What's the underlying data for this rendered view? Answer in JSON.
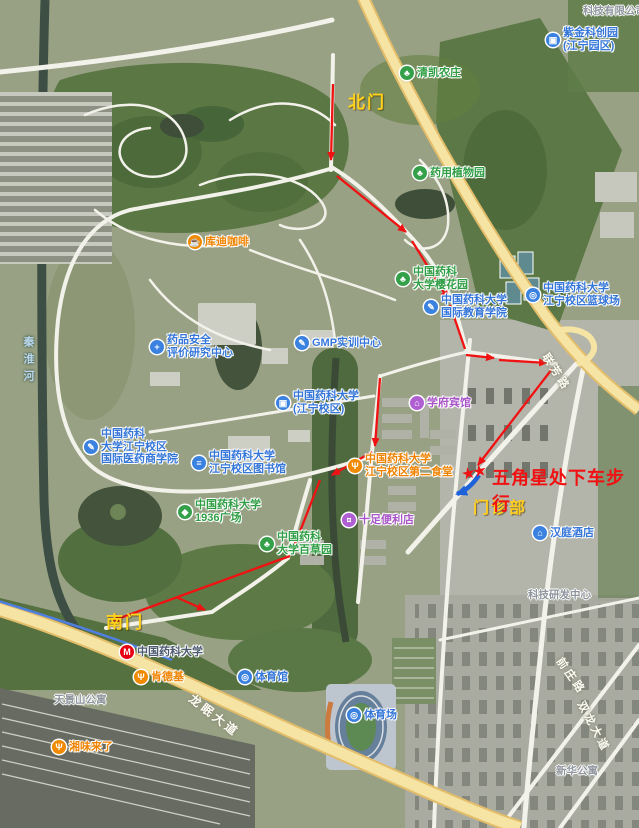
{
  "annotations": {
    "north_gate": "北门",
    "south_gate": "南门",
    "clinic": "门诊部",
    "instruction": "五角星处下车步行",
    "stars": "★★"
  },
  "colors": {
    "route_red": "#f01212",
    "walk_arrow_blue": "#1e62d9",
    "gate_yellow": "#ffd21c",
    "poi_green": "#2f9e44",
    "poi_blue": "#3576d9",
    "poi_orange": "#f08a00",
    "poi_purple": "#b05fd3",
    "metro_red": "#e60012",
    "main_road_yellow": "#f5e4a4"
  },
  "pois": [
    {
      "lines": [
        "清凯农庄"
      ],
      "glyph": "♣",
      "type": "farm"
    },
    {
      "lines": [
        "药用植物园"
      ],
      "glyph": "♣",
      "type": "garden"
    },
    {
      "lines": [
        "库迪咖啡"
      ],
      "glyph": "☕",
      "type": "coffee"
    },
    {
      "lines": [
        "中国药科",
        "大学樱花园"
      ],
      "glyph": "♣",
      "type": "garden"
    },
    {
      "lines": [
        "中国药科大学",
        "国际教育学院"
      ],
      "glyph": "✎",
      "type": "education"
    },
    {
      "lines": [
        "中国药科大学",
        "江宁校区篮球场"
      ],
      "glyph": "◎",
      "type": "sports"
    },
    {
      "lines": [
        "GMP实训中心"
      ],
      "glyph": "✎",
      "type": "education"
    },
    {
      "lines": [
        "药品安全",
        "评价研究中心"
      ],
      "glyph": "+",
      "type": "research"
    },
    {
      "lines": [
        "中国药科大学",
        "(江宁校区)"
      ],
      "glyph": "▣",
      "type": "bus-stop"
    },
    {
      "lines": [
        "学府宾馆"
      ],
      "glyph": "⌂",
      "type": "hotel"
    },
    {
      "lines": [
        "中国药科大学",
        "江宁校区第二食堂"
      ],
      "glyph": "Ψ",
      "type": "canteen"
    },
    {
      "lines": [
        "中国药科",
        "大学江宁校区",
        "国际医药商学院"
      ],
      "glyph": "✎",
      "type": "education"
    },
    {
      "lines": [
        "中国药科大学",
        "江宁校区图书馆"
      ],
      "glyph": "≡",
      "type": "library"
    },
    {
      "lines": [
        "中国药科大学",
        "1936广场"
      ],
      "glyph": "◆",
      "type": "plaza"
    },
    {
      "lines": [
        "中国药科",
        "大学百草园"
      ],
      "glyph": "♣",
      "type": "garden"
    },
    {
      "lines": [
        "十足便利店"
      ],
      "glyph": "¤",
      "type": "store"
    },
    {
      "lines": [
        "中国药科大学"
      ],
      "glyph": "M",
      "type": "metro-station"
    },
    {
      "lines": [
        "肯德基"
      ],
      "glyph": "Ψ",
      "type": "restaurant"
    },
    {
      "lines": [
        "体育馆"
      ],
      "glyph": "◎",
      "type": "sports"
    },
    {
      "lines": [
        "体育场"
      ],
      "glyph": "◎",
      "type": "sports"
    },
    {
      "lines": [
        "湘味来了"
      ],
      "glyph": "Ψ",
      "type": "restaurant"
    },
    {
      "lines": [
        "汉庭酒店"
      ],
      "glyph": "⌂",
      "type": "hotel"
    },
    {
      "lines": [
        "紫金科创园",
        "(江宁园区)"
      ],
      "glyph": "▣",
      "type": "business-park"
    }
  ],
  "area_labels": [
    "天景山公寓",
    "科技研发中心",
    "新华公寓",
    "科技有限公司"
  ],
  "road_labels": {
    "longmian": "龙眠大道",
    "lianfang": "联芳路",
    "qianzhuang": "前庄路",
    "shuanglong": "双龙大道",
    "river": "秦淮河"
  }
}
